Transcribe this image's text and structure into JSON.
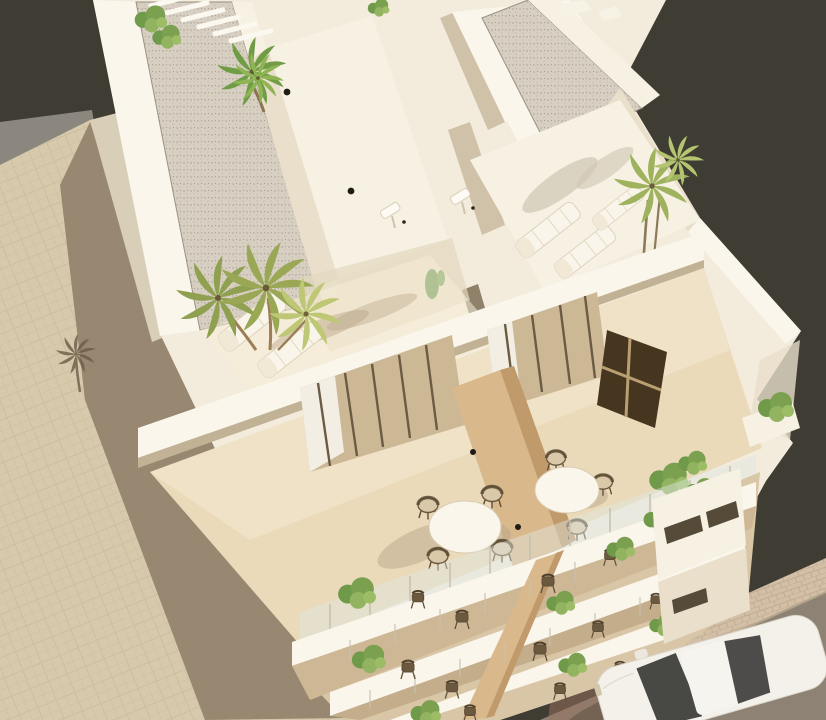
{
  "scene": {
    "type": "architectural-render",
    "view": "aerial bird's-eye 3D visualization",
    "subject": "modern white residential apartment building with rooftop solarium, glass-fronted terraces, stacked balconies, palm trees, street with parked white car"
  },
  "colors": {
    "background": "#3e3c33",
    "fence": "#8b867e",
    "pavement": "#d7c9ac",
    "pavement_shadow": "#8f7e69",
    "sidewalk": "#d2bfa6",
    "road": "#8d8273",
    "road_brick": "#9a715d",
    "building": "#f3ecdd",
    "face_bright": "#faf6ec",
    "face_light": "#f7f1e4",
    "face_shade": "#e9dfca",
    "face_deep": "#cfc2a8",
    "soffit": "#c2b295",
    "slit": "#8f816a",
    "west_wall": "#d9ceb8",
    "gravel_edge": "#9a9284",
    "floor": "#eadaba",
    "floor_light": "#f6ecd6",
    "floor_shade": "#e3d8bf",
    "wood": "#d9b88c",
    "wood_dark": "#c09a6b",
    "window_dark": "#46351f",
    "window_grid": "#b99f72",
    "door_glass": "#cdb896",
    "door_frame": "#6b5b43",
    "curtain": "#f7f4ec",
    "glass": "#dfe7e3",
    "glass_post": "#c9c2b2",
    "palm": "#9aa855",
    "palm_dark": "#7e9142",
    "palm_light": "#bdc774",
    "palm_bright": "#6f9c45",
    "trunk": "#9b7e55",
    "shrub_green": "#7ba04f",
    "soft_shadow": "#b7a588",
    "wall_shadow": "#cfc6b2",
    "shadow_palm": "#6b5c49",
    "lamp": "#201c15",
    "table": "#faf6ec",
    "car_body": "#f4f1ea",
    "car_glass": "#3e3e3c",
    "car_shadow": "#4a4337",
    "curb": "#b3a48c",
    "balcony_base": "#d8c6a6",
    "balcony_in1": "#cdb795",
    "balcony_in2": "#c3ad8b",
    "recess_dark": "#564a38"
  },
  "objects": {
    "gravel_roofs": 2,
    "stair_cores": 2,
    "pergola_slats": 6,
    "roof_boxes": 2,
    "outdoor_showers": 2,
    "cactus": 1,
    "wall_lamps": 4,
    "sun_loungers": 5,
    "palms_left_cluster": 3,
    "palm_top_center": 1,
    "palm_right": 1,
    "roof_planters": 3,
    "bistro_tables": 2,
    "bistro_chairs": 7,
    "wood_privacy_wall": 1,
    "dark_window_panel": 1,
    "balcony_rows": 3,
    "balcony_chairs": 13,
    "balcony_shrubs": 12,
    "cars": 1
  }
}
